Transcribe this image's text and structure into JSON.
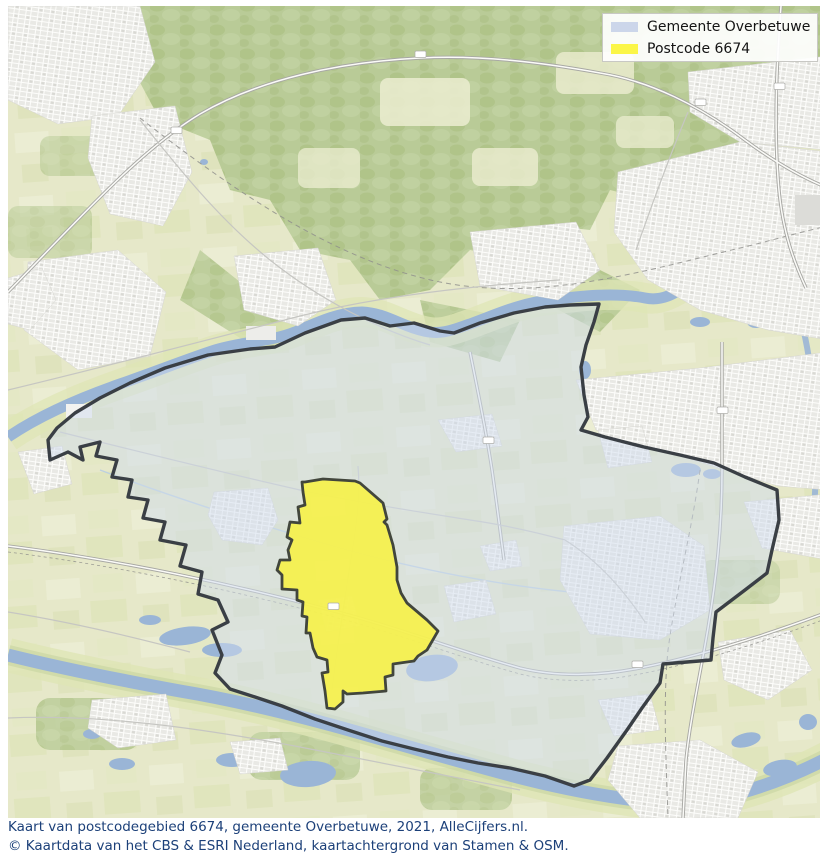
{
  "legend": {
    "items": [
      {
        "label": "Gemeente Overbetuwe",
        "swatch_color": "#ccd6ea"
      },
      {
        "label": "Postcode 6674",
        "swatch_color": "#fbf648"
      }
    ]
  },
  "captions": {
    "line1": "Kaart van postcodegebied 6674, gemeente Overbetuwe, 2021, AlleCijfers.nl.",
    "line2": "© Kaartdata van het CBS & ESRI Nederland, kaartachtergrond van Stamen & OSM."
  },
  "map": {
    "type": "region-outline-map",
    "municipality": {
      "name": "Gemeente Overbetuwe",
      "fill": "#cfdcee",
      "outline": "#3a3f45"
    },
    "postcode": {
      "code": "6674",
      "fill": "#f6f14b",
      "outline": "#42463c"
    },
    "colors": {
      "water": "#9ab5d6",
      "forest": "#b9cb97",
      "fields": "#e6e8c9",
      "urban": "#e9e9e5",
      "floodplain": "#dfe5b5"
    }
  }
}
